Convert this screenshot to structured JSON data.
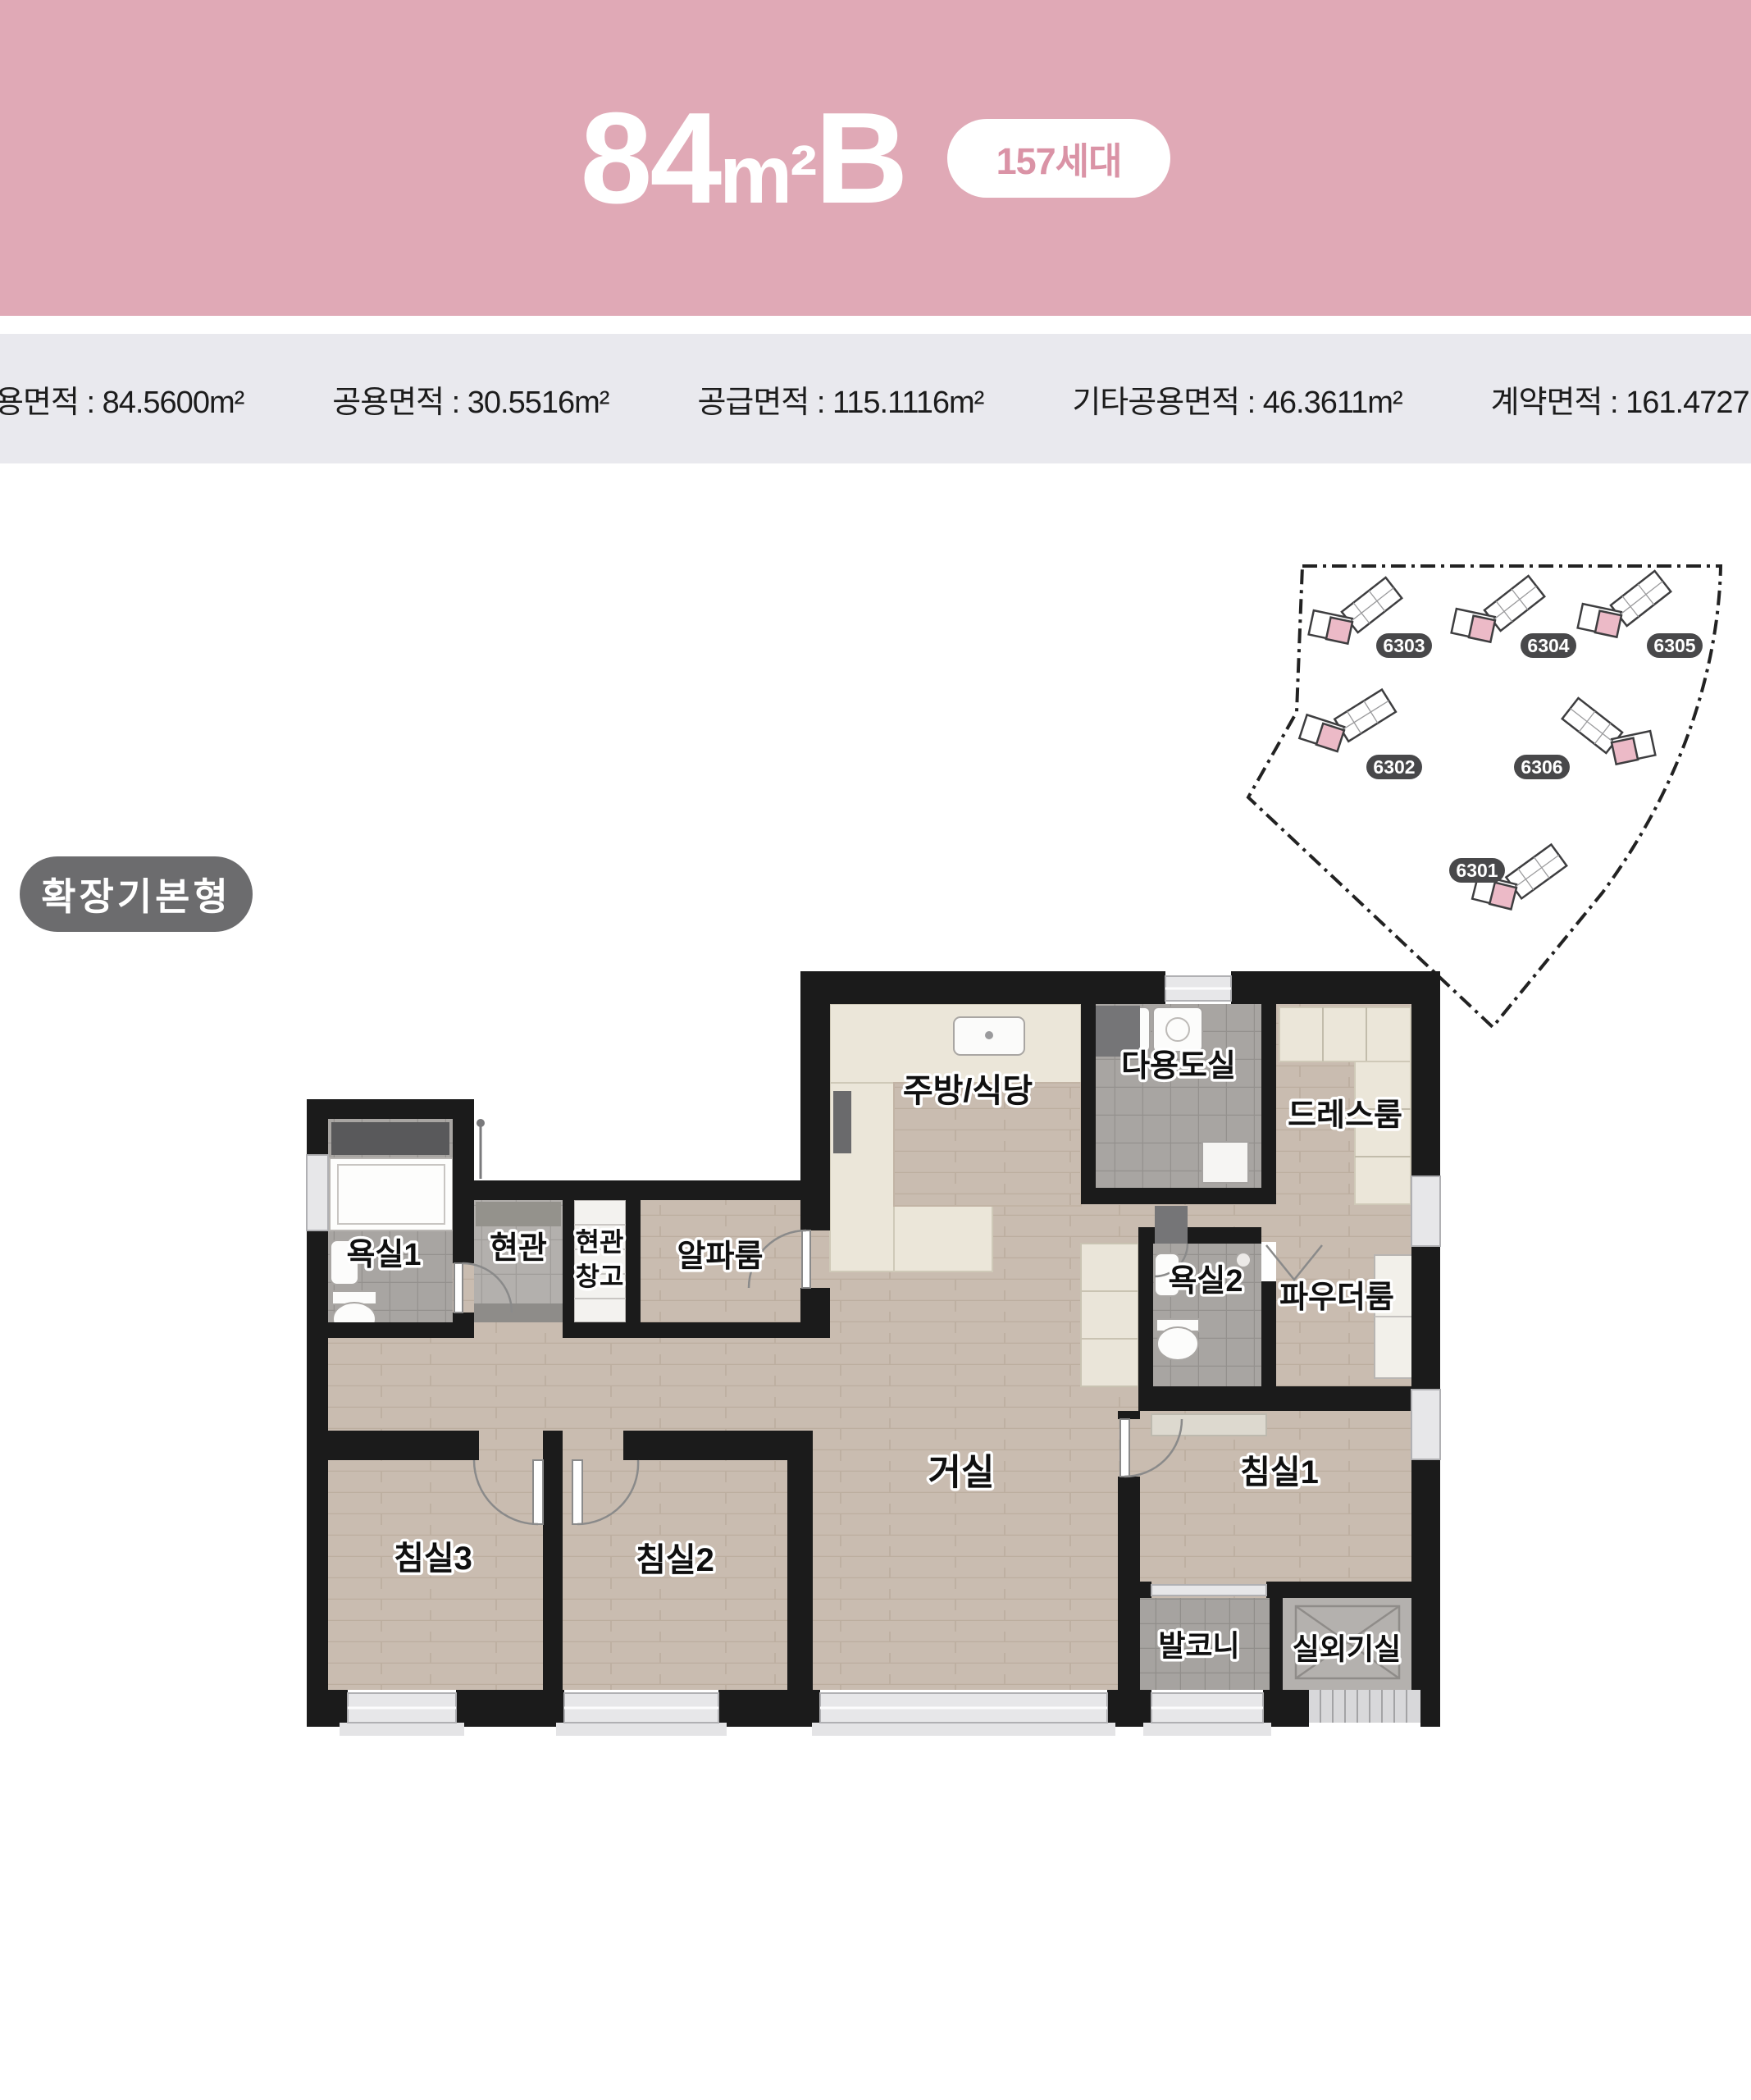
{
  "header": {
    "bg": "#e0a9b6",
    "title": {
      "num": "84",
      "unit": "m²",
      "suffix": "B"
    },
    "badge": {
      "label": "157세대",
      "color": "#da93a6"
    }
  },
  "area_info": {
    "bg": "#e9e9ee",
    "items": [
      "전용면적 : 84.5600m²",
      "공용면적 : 30.5516m²",
      "공급면적 : 115.1116m²",
      "기타공용면적 : 46.3611m²",
      "계약면적 : 161.4727m²"
    ]
  },
  "plan_type": {
    "label": "확장기본형",
    "bg": "#6c6c6e"
  },
  "site_map": {
    "label_bg": "#48484a",
    "unit_highlight_color": "#ecbac7",
    "buildings": [
      {
        "id": "6303"
      },
      {
        "id": "6304"
      },
      {
        "id": "6305"
      },
      {
        "id": "6302"
      },
      {
        "id": "6306"
      },
      {
        "id": "6301"
      }
    ]
  },
  "floor_plan": {
    "wall_color": "#1b1b1b",
    "wood_color": "#c9bcb0",
    "labels": [
      "주방/식당",
      "다용도실",
      "드레스룸",
      "욕실2",
      "파우더룸",
      "욕실1",
      "현관",
      "현관",
      "창고",
      "알파룸",
      "거실",
      "침실1",
      "침실3",
      "침실2",
      "발코니",
      "실외기실"
    ]
  }
}
